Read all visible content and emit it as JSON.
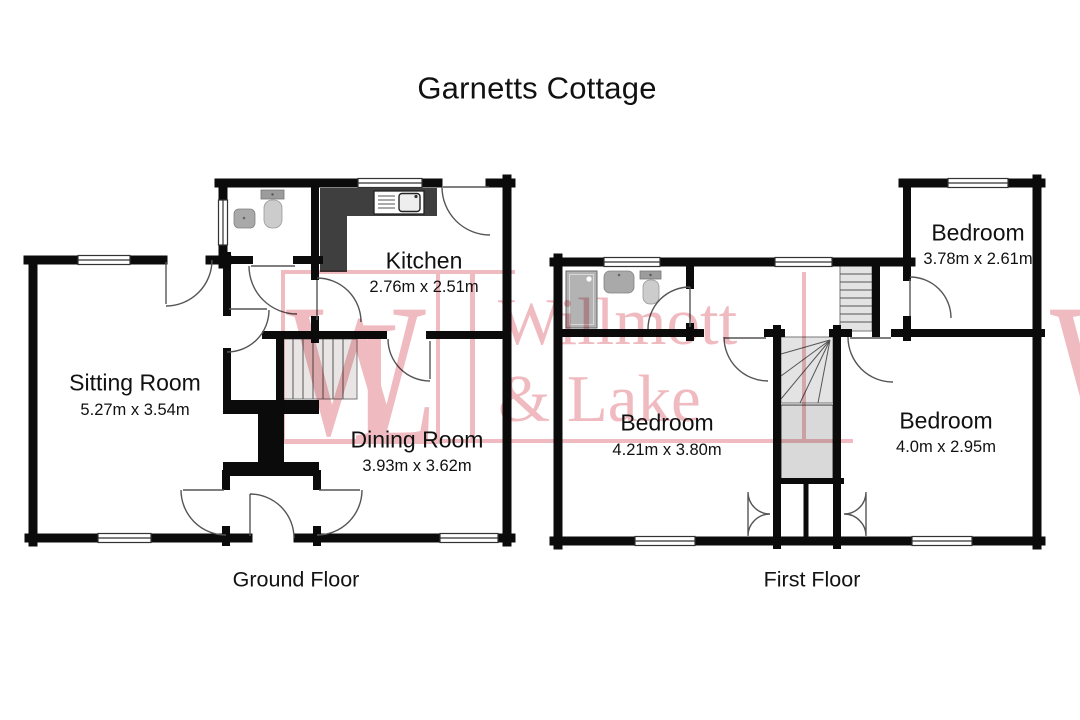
{
  "title": "Garnetts Cottage",
  "watermark": {
    "monogram_w": "W",
    "monogram_l": "L",
    "name_line1": "Willmott",
    "name_line2": "& Lake",
    "color": "#efb5bb"
  },
  "ground_floor": {
    "label": "Ground Floor",
    "rooms": [
      {
        "name": "Sitting Room",
        "dims": "5.27m x 3.54m"
      },
      {
        "name": "Kitchen",
        "dims": "2.76m x 2.51m"
      },
      {
        "name": "Dining Room",
        "dims": "3.93m x 3.62m"
      }
    ]
  },
  "first_floor": {
    "label": "First Floor",
    "rooms": [
      {
        "name": "Bedroom",
        "dims": "3.78m x 2.61m"
      },
      {
        "name": "Bedroom",
        "dims": "4.21m x 3.80m"
      },
      {
        "name": "Bedroom",
        "dims": "4.0m x 2.95m"
      }
    ]
  }
}
